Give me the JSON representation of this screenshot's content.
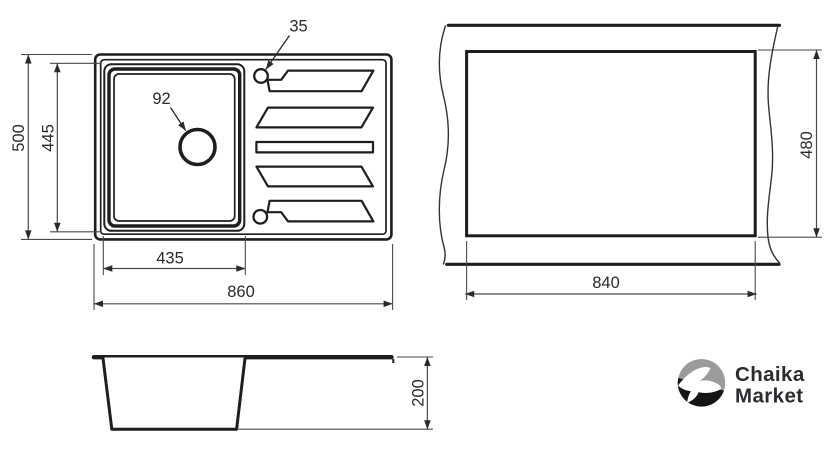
{
  "plan_view": {
    "overall_width_label": "860",
    "overall_depth_label": "500",
    "bowl_width_label": "435",
    "bowl_depth_label": "445",
    "drain_diameter_label": "92",
    "tap_hole_diameter_label": "35"
  },
  "cutout_view": {
    "cutout_width_label": "840",
    "cutout_height_label": "480"
  },
  "side_view": {
    "depth_label": "200"
  },
  "logo": {
    "brand_line1": "Chaika",
    "brand_line2": "Market"
  },
  "colors": {
    "line": "#1e1e1e",
    "dim_line": "#4a4a4a",
    "logo_gray": "#9b9b9b",
    "logo_black": "#151515",
    "logo_text": "#2b2b30"
  }
}
